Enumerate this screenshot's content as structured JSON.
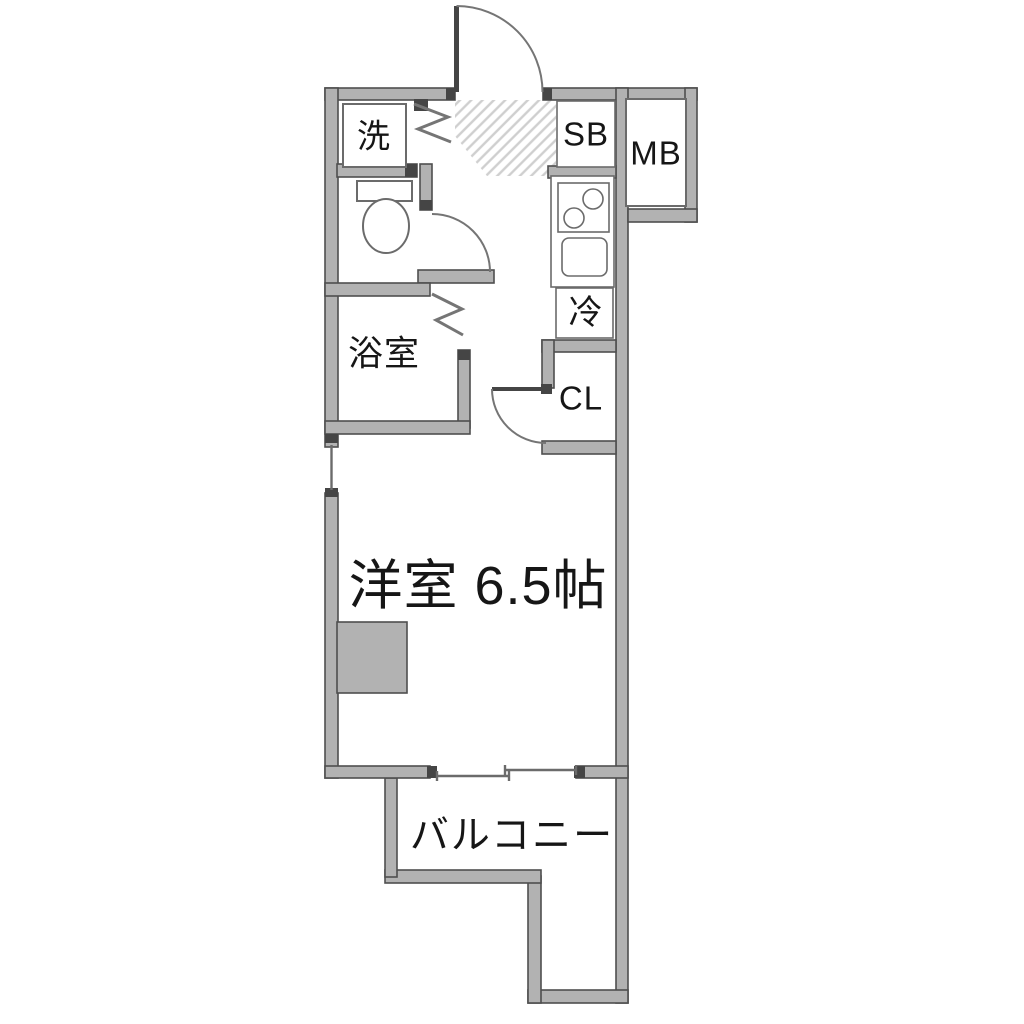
{
  "plan": {
    "type": "apartment-floor-plan",
    "labels": {
      "laundry": "洗",
      "shoe_box": "SB",
      "meter_box": "MB",
      "refrigerator": "冷",
      "closet": "CL",
      "bathroom": "浴室",
      "western_room": "洋室 6.5帖",
      "balcony": "バルコニー"
    },
    "colors": {
      "background": "#ffffff",
      "wall_fill": "#b2b2b2",
      "wall_stroke": "#4f4f4f",
      "cap": "#454545",
      "fixture_stroke": "#6b6b6b",
      "door_stroke": "#757575",
      "hatch_stroke": "#cfcfcf",
      "text": "#161616"
    }
  }
}
